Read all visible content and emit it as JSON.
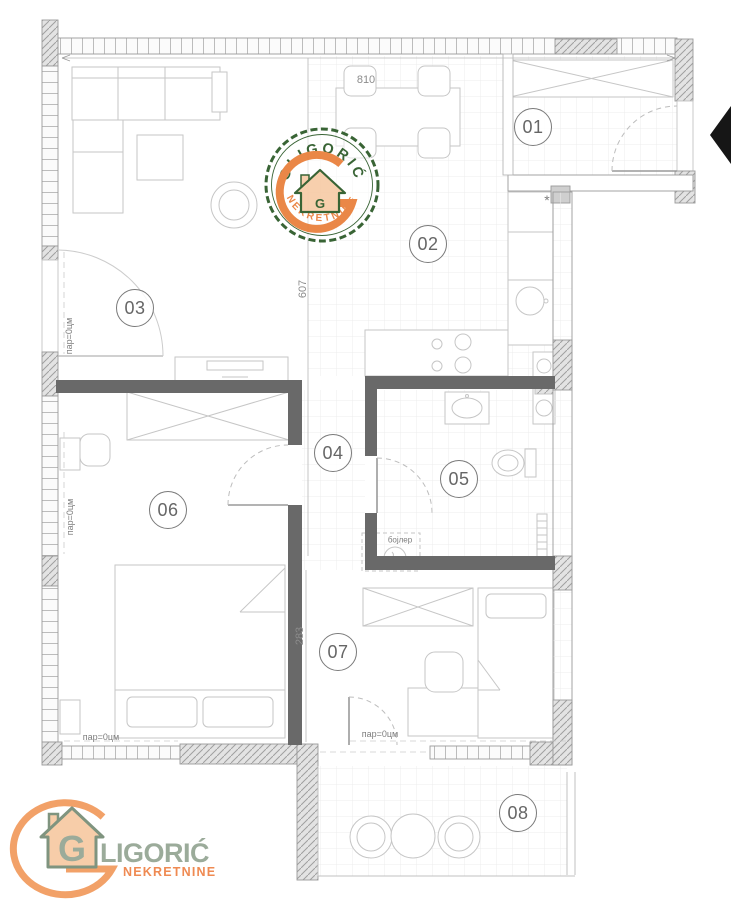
{
  "plan": {
    "room_labels": [
      {
        "number": "01",
        "x": 533,
        "y": 127
      },
      {
        "number": "02",
        "x": 428,
        "y": 244
      },
      {
        "number": "03",
        "x": 135,
        "y": 308
      },
      {
        "number": "04",
        "x": 333,
        "y": 453
      },
      {
        "number": "05",
        "x": 459,
        "y": 479
      },
      {
        "number": "06",
        "x": 168,
        "y": 510
      },
      {
        "number": "07",
        "x": 338,
        "y": 652
      },
      {
        "number": "08",
        "x": 518,
        "y": 813
      }
    ],
    "dimensions": [
      {
        "text": "810",
        "x": 366,
        "y": 80,
        "rotate": 0
      },
      {
        "text": "607",
        "x": 303,
        "y": 289,
        "rotate": -90
      },
      {
        "text": "283",
        "x": 300,
        "y": 636,
        "rotate": -90
      }
    ],
    "annotations": [
      {
        "text": "пар=0цм",
        "x": 69,
        "y": 336,
        "rotate": -90,
        "size": 9
      },
      {
        "text": "пар=0цм",
        "x": 70,
        "y": 517,
        "rotate": -90,
        "size": 9
      },
      {
        "text": "пар=0цм",
        "x": 101,
        "y": 737,
        "rotate": 0,
        "size": 9
      },
      {
        "text": "пар=0цм",
        "x": 380,
        "y": 734,
        "rotate": 0,
        "size": 9
      },
      {
        "text": "бојлер",
        "x": 400,
        "y": 540,
        "rotate": 0,
        "size": 8
      },
      {
        "text": "*",
        "x": 547,
        "y": 200,
        "rotate": 0,
        "size": 14
      }
    ]
  },
  "watermark": {
    "arc_top": "GLIGORIĆ",
    "arc_bottom": "NEKRETNINE",
    "house_letter": "G"
  },
  "footer_logo": {
    "house_letter": "G",
    "brand_rest": "LIGORIĆ",
    "subtitle": "NEKRETNINE"
  },
  "colors": {
    "green": "#2f5c2b",
    "orange": "#e9813e",
    "peach": "#f7cda9",
    "logo_green": "#9bab9a",
    "house_green": "#7f947f",
    "logo_orange": "#f2a168",
    "logo_orange_text": "#ef8a52",
    "line_gray": "#8f8f8f",
    "wall_dark": "#696969",
    "arrow": "#161616"
  }
}
